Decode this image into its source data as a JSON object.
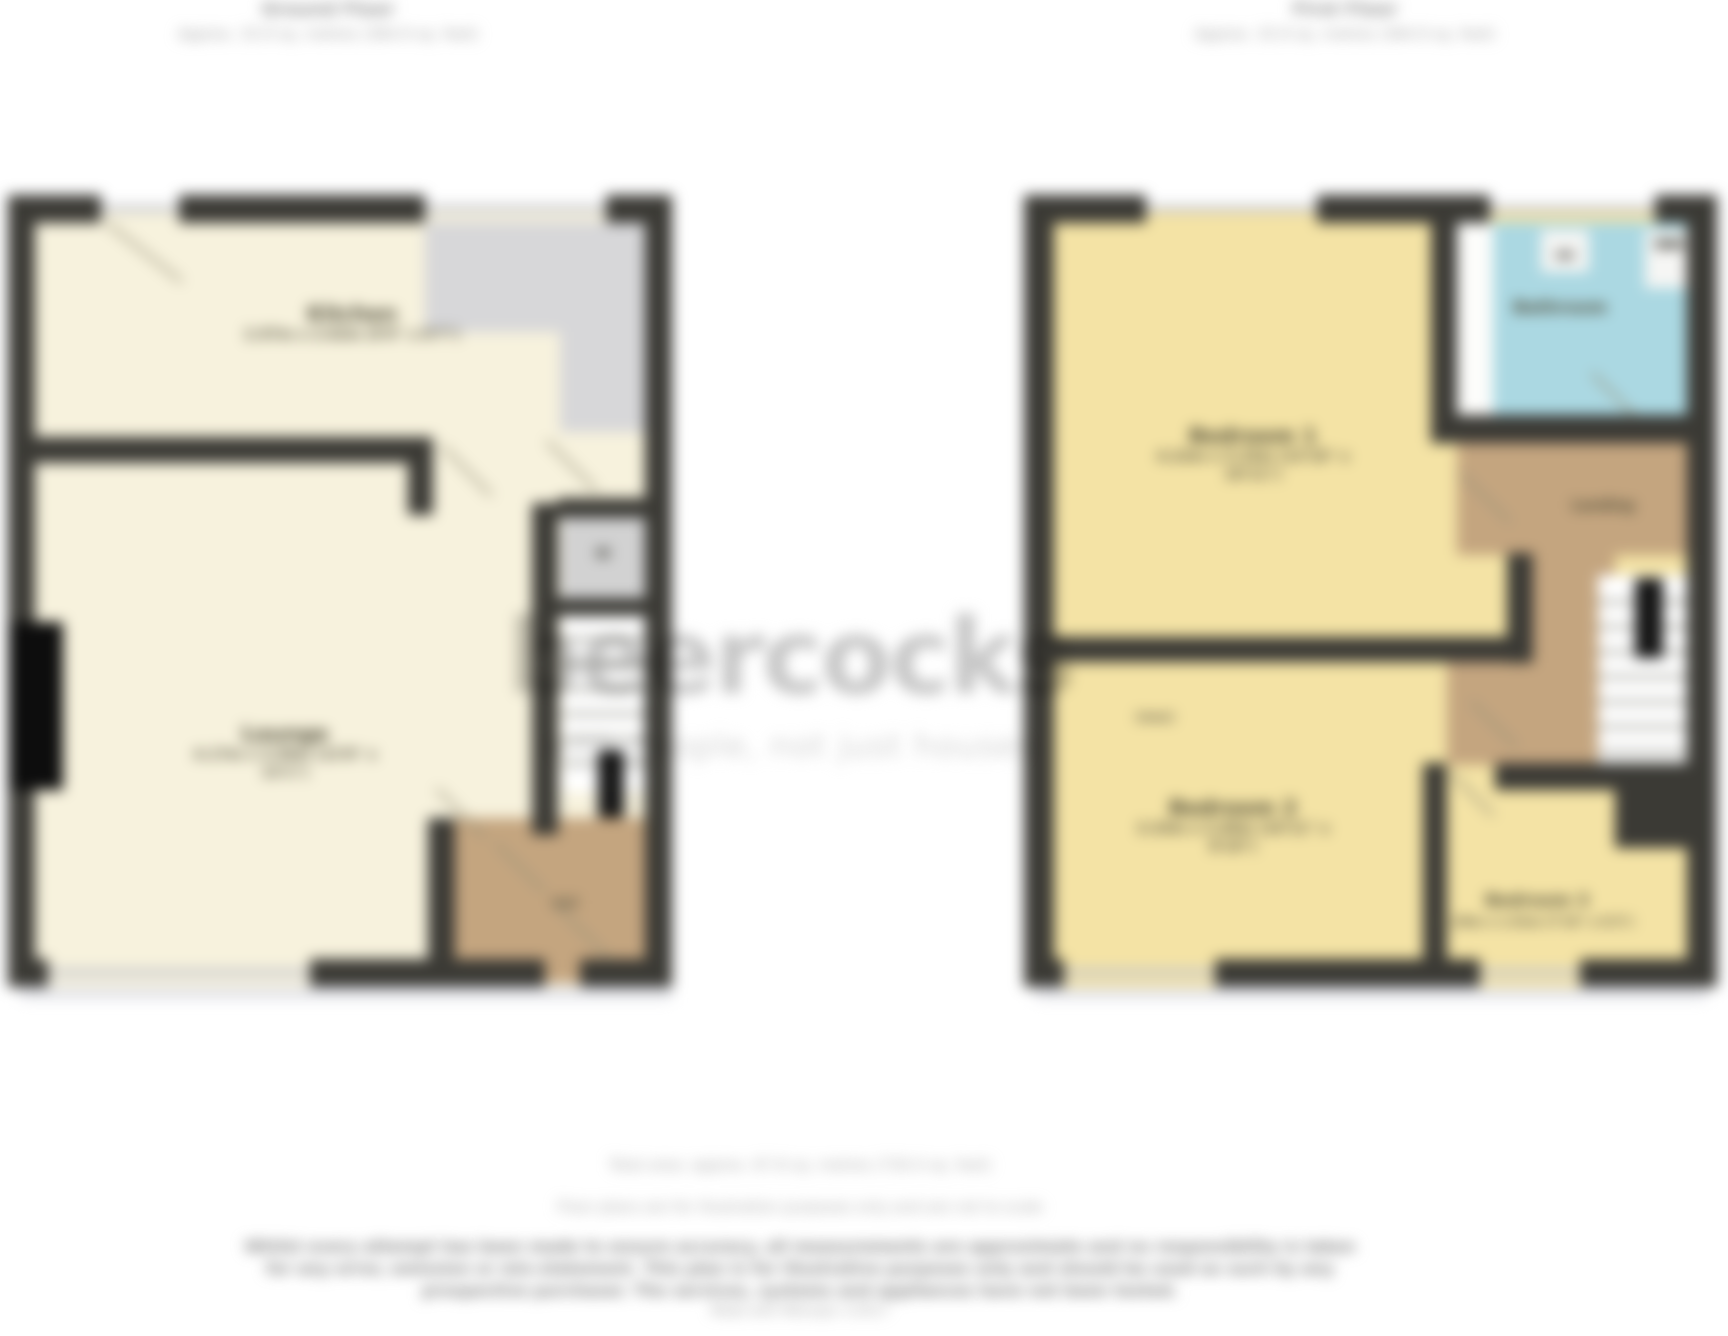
{
  "plans": {
    "ground": {
      "title": "Ground Floor",
      "subtitle": "Approx. 33.9 sq. metres (364.9 sq. feet)",
      "rooms": {
        "kitchen": {
          "name": "Kitchen",
          "dims": "2.97m x 2.62m (9'9\" x 8'7\")"
        },
        "lounge": {
          "name": "Lounge",
          "dims": "4.17m x 3.99m (13'8\" x 13'1\")"
        },
        "hall": {
          "name": "Hall"
        }
      }
    },
    "first": {
      "title": "First Floor",
      "subtitle": "Approx. 33.9 sq. metres (364.9 sq. feet)",
      "rooms": {
        "bedroom1": {
          "name": "Bedroom 1",
          "dims": "4.22m x 3.33m (13'10\" x 10'11\")"
        },
        "bedroom2": {
          "name": "Bedroom 2",
          "dims": "3.33m x 2.69m (10'11\" x 8'10\")",
          "note": "(max)"
        },
        "bedroom3": {
          "name": "Bedroom 3",
          "dims": "2.39m x 1.91m (7'10\" x 6'3\")"
        },
        "bathroom": {
          "name": "Bathroom"
        },
        "landing": {
          "name": "Landing"
        }
      }
    }
  },
  "watermark": {
    "brand": "beercocks",
    "tagline": "with people, not just houses"
  },
  "footer": {
    "total_area": "Total area: approx. 67.8 sq. metres (730.0 sq. feet)",
    "scale_note": "Floor plans are for illustration purposes only and are not to scale",
    "disclaimer_1": "Whilst every attempt has been made to ensure accuracy, all measurements are approximate and no responsibility is taken",
    "disclaimer_2": "for any error, omission or mis-statement. This plan is for illustrative purposes only and should be used as such by any",
    "disclaimer_3": "prospective purchaser. The services, systems and appliances have not been tested.",
    "produced_by": "Made with Metropix ©2017"
  },
  "colors": {
    "wall": "#3b3a35",
    "ground_floor_fill": "#f7f2dd",
    "first_floor_fill": "#f4e3a5",
    "bathroom_fill": "#abd8e2",
    "hall_fill": "#c4a57f",
    "counter_fill": "#d7d7d9",
    "watermark_gray": "#c6c6c6"
  }
}
